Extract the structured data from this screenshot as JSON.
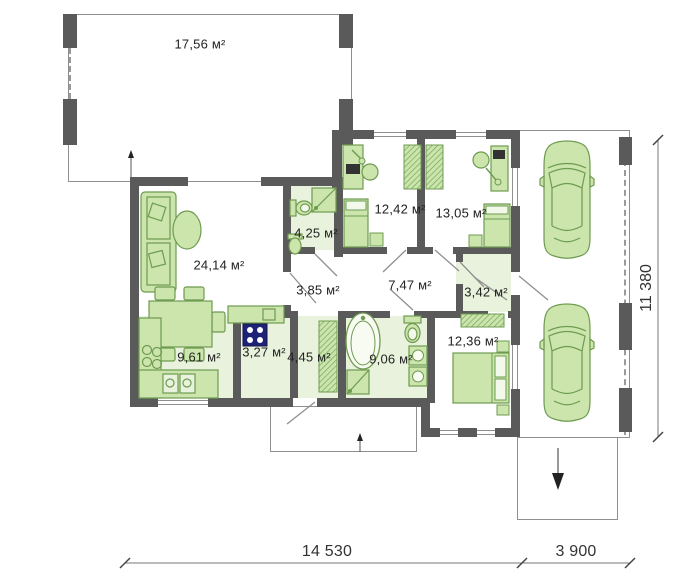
{
  "plan_title": "single-storey house floor plan with carport",
  "colors": {
    "wall": "#5a5a5a",
    "furniture_fill": "#cbe5ad",
    "furniture_stroke": "#6e9b50",
    "wet_room_floor": "#e9f2dc",
    "stove": "#1e2277",
    "thin_line": "#8f8f8f",
    "text": "#222222"
  },
  "rooms": [
    {
      "name": "terrace",
      "area": "17,56 м²"
    },
    {
      "name": "living-room",
      "area": "24,14 м²"
    },
    {
      "name": "bathroom-small",
      "area": "4,25 м²"
    },
    {
      "name": "bedroom-1",
      "area": "12,42 м²"
    },
    {
      "name": "bedroom-2",
      "area": "13,05 м²"
    },
    {
      "name": "hallway",
      "area": "3,85 м²"
    },
    {
      "name": "corridor",
      "area": "7,47 м²"
    },
    {
      "name": "entry",
      "area": "3,42 м²"
    },
    {
      "name": "kitchen",
      "area": "9,61 м²"
    },
    {
      "name": "pantry",
      "area": "3,27 м²"
    },
    {
      "name": "hall",
      "area": "4,45 м²"
    },
    {
      "name": "bathroom-main",
      "area": "9,06 м²"
    },
    {
      "name": "bedroom-3",
      "area": "12,36 м²"
    }
  ],
  "dimensions": {
    "bottom_main": "14 530",
    "bottom_carport": "3 900",
    "right_side": "11 380"
  }
}
